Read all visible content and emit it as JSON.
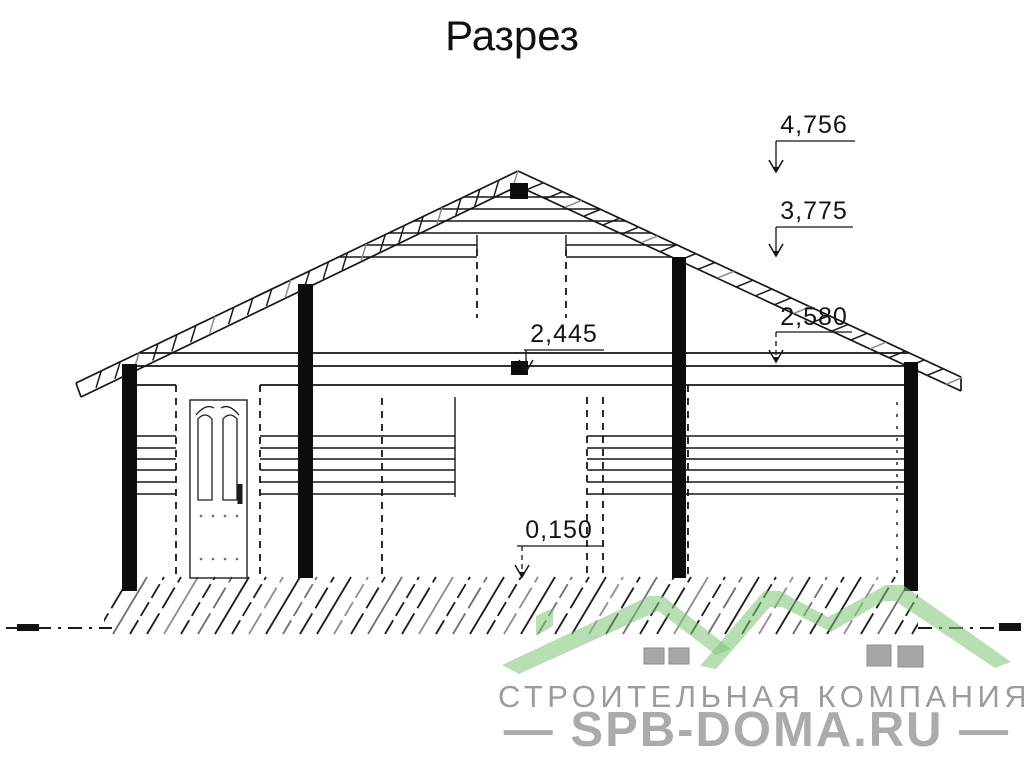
{
  "title": "Разрез",
  "dimensions": [
    {
      "label": "4,756"
    },
    {
      "label": "3,775"
    },
    {
      "label": "2,580"
    },
    {
      "label": "2,445"
    },
    {
      "label": "0,150"
    }
  ],
  "watermark": {
    "company": "СТРОИТЕЛЬНАЯ КОМПАНИЯ",
    "site": "— SPB-DOMA.RU —"
  },
  "colors": {
    "line": "#1b1b1b",
    "hatch_gray": "#7a7a7a",
    "logo_green": "#7cc474",
    "logo_window_gray": "#a6a6a6",
    "watermark_text_gray": "#9c9c9c",
    "site_text_gray": "#ababab"
  }
}
